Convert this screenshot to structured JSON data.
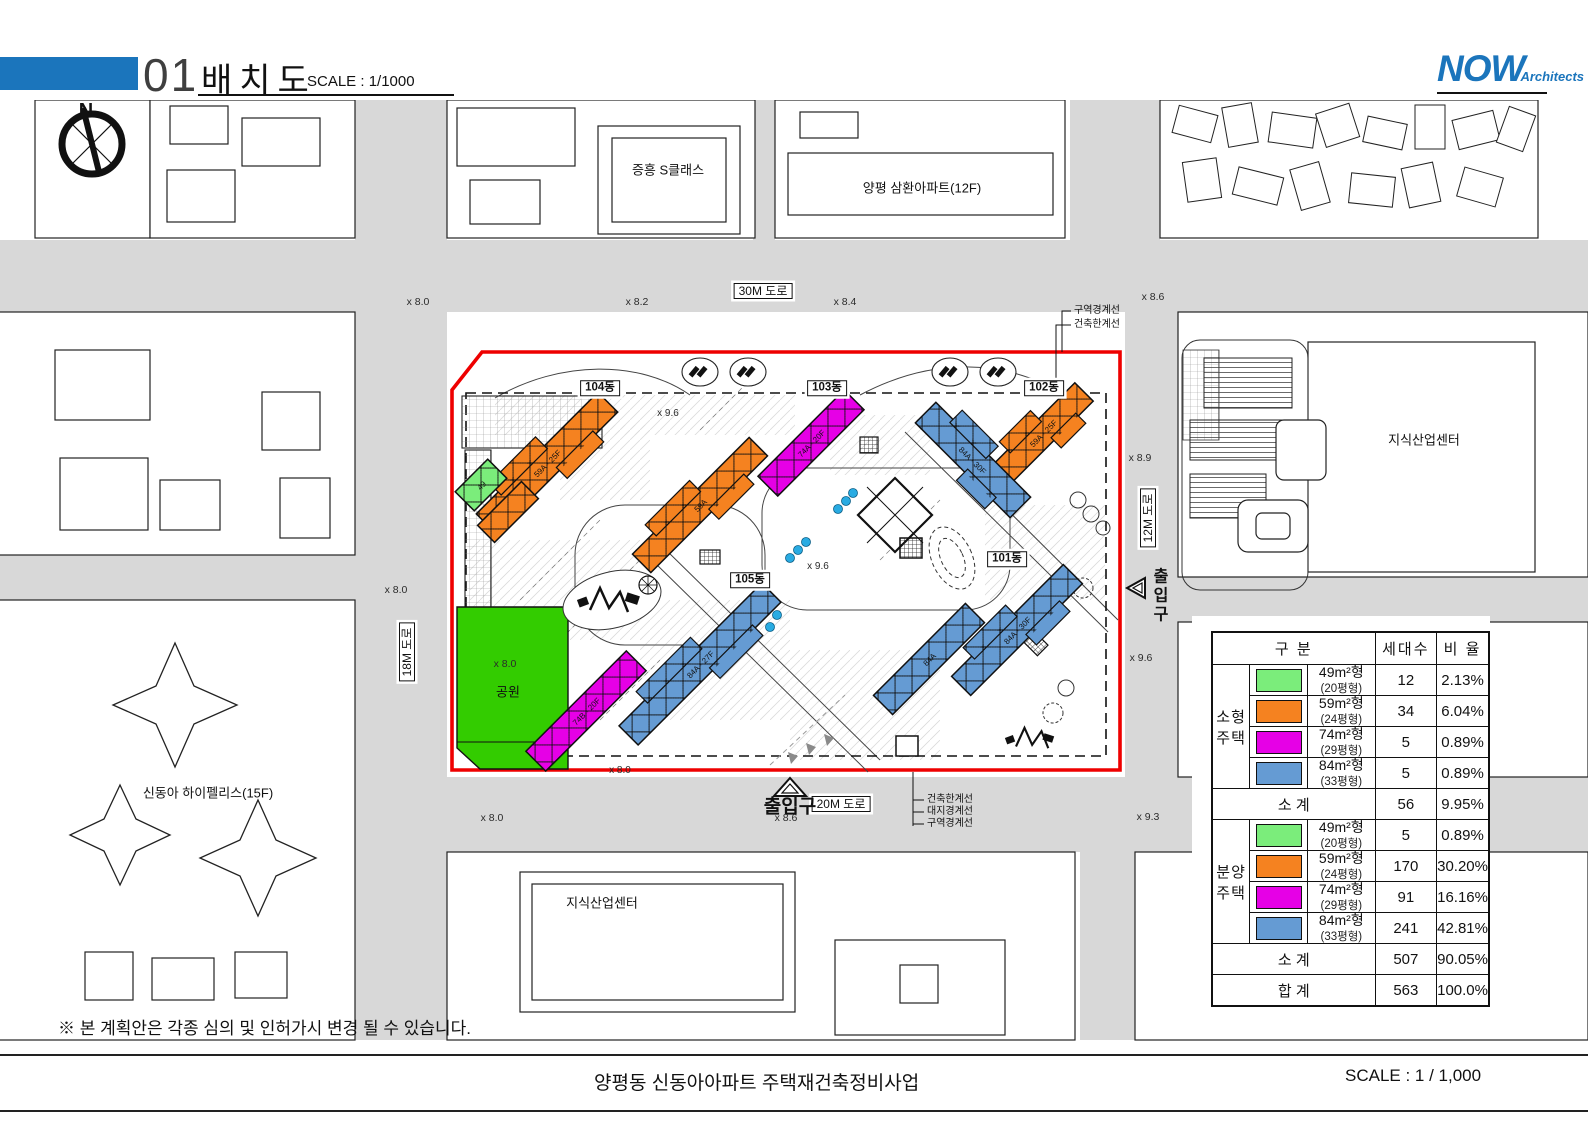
{
  "header": {
    "sheet_number": "01",
    "title": "배치도",
    "scale": "SCALE : 1/1000",
    "logo_main": "NOW",
    "logo_sub": "Architects"
  },
  "footer": {
    "note": "※ 본 계획안은 각종 심의 및 인허가시 변경 될 수 있습니다.",
    "project_title": "양평동 신동아아파트 주택재건축정비사업",
    "scale": "SCALE : 1 / 1,000"
  },
  "colors": {
    "green": "#7BED7B",
    "orange": "#F58220",
    "magenta": "#E600E6",
    "blue": "#659BD3",
    "park": "#33CC00",
    "boundary_red": "#EE0000",
    "road_gray": "#D8D8D8",
    "brand_blue": "#1B75BC",
    "dot_blue": "#29ABE2"
  },
  "map": {
    "labels": [
      {
        "t": "N",
        "x": 86,
        "y": 111,
        "s": 20,
        "cls": "bold",
        "n": "north-label"
      },
      {
        "t": "증흥 S클래스",
        "x": 668,
        "y": 170,
        "s": 13,
        "n": "neighbor-building-label"
      },
      {
        "t": "양평 삼환아파트(12F)",
        "x": 922,
        "y": 188,
        "s": 13,
        "n": "neighbor-building-label"
      },
      {
        "t": "지식산업센터",
        "x": 1424,
        "y": 440,
        "s": 13,
        "n": "neighbor-building-label"
      },
      {
        "t": "지식산업센터",
        "x": 602,
        "y": 903,
        "s": 13,
        "n": "neighbor-building-label"
      },
      {
        "t": "신동아 하이펠리스(15F)",
        "x": 208,
        "y": 793,
        "s": 13,
        "n": "neighbor-building-label"
      },
      {
        "t": "30M 도로",
        "x": 763,
        "y": 291,
        "s": 12,
        "cls": "box",
        "n": "road-label-30m"
      },
      {
        "t": "20M 도로",
        "x": 841,
        "y": 804,
        "s": 12,
        "cls": "box",
        "n": "road-label-20m"
      },
      {
        "t": "18M 도로",
        "x": 407,
        "y": 652,
        "s": 12,
        "cls": "box vert",
        "n": "road-label-18m"
      },
      {
        "t": "12M 도로",
        "x": 1148,
        "y": 518,
        "s": 12,
        "cls": "box vert",
        "n": "road-label-12m"
      },
      {
        "t": "104동",
        "x": 600,
        "y": 388,
        "s": 11.5,
        "cls": "box bold",
        "n": "building-label-104"
      },
      {
        "t": "103동",
        "x": 827,
        "y": 388,
        "s": 11.5,
        "cls": "box bold",
        "n": "building-label-103"
      },
      {
        "t": "102동",
        "x": 1044,
        "y": 388,
        "s": 11.5,
        "cls": "box bold",
        "n": "building-label-102"
      },
      {
        "t": "101동",
        "x": 1007,
        "y": 559,
        "s": 11.5,
        "cls": "box bold",
        "n": "building-label-101"
      },
      {
        "t": "105동",
        "x": 750,
        "y": 580,
        "s": 11.5,
        "cls": "box bold",
        "n": "building-label-105"
      },
      {
        "t": "출입구",
        "x": 790,
        "y": 807,
        "s": 19,
        "cls": "bold",
        "n": "entrance-label-south"
      },
      {
        "t": "출입구",
        "x": 1158,
        "y": 596,
        "s": 16,
        "cls": "bold vtext",
        "n": "entrance-label-east"
      },
      {
        "t": "공원",
        "x": 508,
        "y": 692,
        "s": 13,
        "n": "park-label"
      },
      {
        "t": "x 8.0",
        "x": 505,
        "y": 664,
        "s": 10.5,
        "cls": "gray",
        "n": "spot-elevation"
      },
      {
        "t": "x 8.0",
        "x": 418,
        "y": 302,
        "s": 10.5,
        "cls": "gray",
        "n": "spot-elevation"
      },
      {
        "t": "x 8.2",
        "x": 637,
        "y": 302,
        "s": 10.5,
        "cls": "gray",
        "n": "spot-elevation"
      },
      {
        "t": "x 8.4",
        "x": 845,
        "y": 302,
        "s": 10.5,
        "cls": "gray",
        "n": "spot-elevation"
      },
      {
        "t": "x 8.6",
        "x": 1153,
        "y": 297,
        "s": 10.5,
        "cls": "gray",
        "n": "spot-elevation"
      },
      {
        "t": "x 8.9",
        "x": 1140,
        "y": 458,
        "s": 10.5,
        "cls": "gray",
        "n": "spot-elevation"
      },
      {
        "t": "x 9.6",
        "x": 1141,
        "y": 658,
        "s": 10.5,
        "cls": "gray",
        "n": "spot-elevation"
      },
      {
        "t": "x 9.3",
        "x": 1148,
        "y": 817,
        "s": 10.5,
        "cls": "gray",
        "n": "spot-elevation"
      },
      {
        "t": "x 8.0",
        "x": 396,
        "y": 590,
        "s": 10.5,
        "cls": "gray",
        "n": "spot-elevation"
      },
      {
        "t": "x 8.0",
        "x": 492,
        "y": 818,
        "s": 10.5,
        "cls": "gray",
        "n": "spot-elevation"
      },
      {
        "t": "x 8.6",
        "x": 786,
        "y": 818,
        "s": 10.5,
        "cls": "gray",
        "n": "spot-elevation"
      },
      {
        "t": "x 9.6",
        "x": 818,
        "y": 567,
        "s": 10,
        "cls": "gray",
        "n": "spot-elevation"
      },
      {
        "t": "x 8.0",
        "x": 620,
        "y": 771,
        "s": 10,
        "cls": "gray",
        "n": "spot-elevation"
      },
      {
        "t": "x 9.6",
        "x": 668,
        "y": 414,
        "s": 10,
        "cls": "gray",
        "n": "spot-elevation"
      },
      {
        "t": "구역경계선",
        "x": 1074,
        "y": 311,
        "s": 10,
        "cls": "left",
        "n": "boundary-note"
      },
      {
        "t": "건축한계선",
        "x": 1074,
        "y": 325,
        "s": 10,
        "cls": "left",
        "n": "boundary-note"
      },
      {
        "t": "건축한계선",
        "x": 927,
        "y": 800,
        "s": 10,
        "cls": "left",
        "n": "boundary-note"
      },
      {
        "t": "대지경계선",
        "x": 927,
        "y": 812,
        "s": 10,
        "cls": "left",
        "n": "boundary-note"
      },
      {
        "t": "구역경계선",
        "x": 927,
        "y": 824,
        "s": 10,
        "cls": "left",
        "n": "boundary-note"
      }
    ],
    "buildings": [
      {
        "name": "104-59",
        "color": "orange",
        "cx": 547,
        "cy": 463,
        "len": 172,
        "w": 28,
        "rot": -45,
        "step": true,
        "tag": "59A · 25F"
      },
      {
        "name": "104-wing",
        "color": "orange",
        "cx": 508,
        "cy": 512,
        "len": 62,
        "w": 24,
        "rot": -45,
        "tag": ""
      },
      {
        "name": "49-small",
        "color": "green",
        "cx": 481,
        "cy": 485,
        "len": 46,
        "w": 27,
        "rot": -45,
        "tag": "49"
      },
      {
        "name": "103-74",
        "color": "magenta",
        "cx": 811,
        "cy": 443,
        "len": 122,
        "w": 28,
        "rot": -45,
        "tag": "74A · 20F"
      },
      {
        "name": "103-59",
        "color": "orange",
        "cx": 700,
        "cy": 505,
        "len": 165,
        "w": 26,
        "rot": -45,
        "step": true,
        "tag": "59A"
      },
      {
        "name": "102-59",
        "color": "orange",
        "cx": 1043,
        "cy": 433,
        "len": 116,
        "w": 26,
        "rot": -45,
        "step": true,
        "tag": "59A · 25F"
      },
      {
        "name": "102-84",
        "color": "blue",
        "cx": 973,
        "cy": 460,
        "len": 134,
        "w": 29,
        "rot": 45,
        "step": true,
        "tag": "84A · 30F"
      },
      {
        "name": "101-84a",
        "color": "blue",
        "cx": 1017,
        "cy": 630,
        "len": 158,
        "w": 27,
        "rot": -45,
        "step": true,
        "tag": "84A · 30F"
      },
      {
        "name": "101-84b",
        "color": "blue",
        "cx": 929,
        "cy": 659,
        "len": 130,
        "w": 27,
        "rot": -45,
        "tag": "84A"
      },
      {
        "name": "105-84",
        "color": "blue",
        "cx": 700,
        "cy": 664,
        "len": 202,
        "w": 27,
        "rot": -45,
        "step": true,
        "tag": "84A · 27F"
      },
      {
        "name": "105-74",
        "color": "magenta",
        "cx": 586,
        "cy": 711,
        "len": 142,
        "w": 28,
        "rot": -45,
        "tag": "74B · 20F"
      }
    ]
  },
  "legend_table": {
    "col_headers": [
      "구      분",
      "세대수",
      "비  율"
    ],
    "groups": [
      {
        "name_lines": [
          "소형",
          "주택"
        ],
        "rows": [
          {
            "color": "green",
            "type": "49m²형",
            "pyeong": "(20평형)",
            "units": "12",
            "ratio": "2.13%"
          },
          {
            "color": "orange",
            "type": "59m²형",
            "pyeong": "(24평형)",
            "units": "34",
            "ratio": "6.04%"
          },
          {
            "color": "magenta",
            "type": "74m²형",
            "pyeong": "(29평형)",
            "units": "5",
            "ratio": "0.89%"
          },
          {
            "color": "blue",
            "type": "84m²형",
            "pyeong": "(33평형)",
            "units": "5",
            "ratio": "0.89%"
          }
        ],
        "subtotal": {
          "label": "소  계",
          "units": "56",
          "ratio": "9.95%"
        }
      },
      {
        "name_lines": [
          "분양",
          "주택"
        ],
        "rows": [
          {
            "color": "green",
            "type": "49m²형",
            "pyeong": "(20평형)",
            "units": "5",
            "ratio": "0.89%"
          },
          {
            "color": "orange",
            "type": "59m²형",
            "pyeong": "(24평형)",
            "units": "170",
            "ratio": "30.20%"
          },
          {
            "color": "magenta",
            "type": "74m²형",
            "pyeong": "(29평형)",
            "units": "91",
            "ratio": "16.16%"
          },
          {
            "color": "blue",
            "type": "84m²형",
            "pyeong": "(33평형)",
            "units": "241",
            "ratio": "42.81%"
          }
        ],
        "subtotal": {
          "label": "소  계",
          "units": "507",
          "ratio": "90.05%"
        }
      }
    ],
    "total": {
      "label": "합      계",
      "units": "563",
      "ratio": "100.0%"
    }
  }
}
